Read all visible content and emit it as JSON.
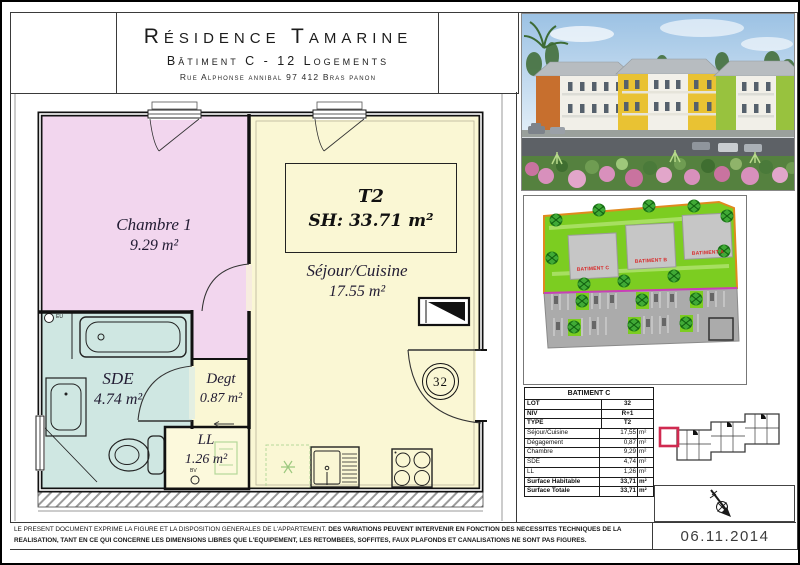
{
  "header": {
    "title": "Résidence Tamarine",
    "subtitle": "Bâtiment C - 12 Logements",
    "address": "Rue Alphonse annibal 97 412 Bras panon"
  },
  "plan": {
    "unit_type": "T2",
    "unit_surface": "SH: 33.71 m²",
    "rooms": [
      {
        "name": "Chambre 1",
        "area": "9.29 m²"
      },
      {
        "name": "Séjour/Cuisine",
        "area": "17.55 m²"
      },
      {
        "name": "SDE",
        "area": "4.74 m²"
      },
      {
        "name": "Degt",
        "area": "0.87 m²"
      },
      {
        "name": "LL",
        "area": "1.26 m²"
      }
    ],
    "lot_number": "32",
    "marks": {
      "eu": "EU",
      "bv": "BV"
    }
  },
  "site_plan": {
    "buildings": [
      "BATIMENT C",
      "BATIMENT B",
      "BATIMENT A"
    ]
  },
  "table": {
    "title": "BATIMENT C",
    "rows": [
      {
        "label": "LOT",
        "value": "32",
        "unit": ""
      },
      {
        "label": "NIV",
        "value": "R+1",
        "unit": ""
      },
      {
        "label": "TYPE",
        "value": "T2",
        "unit": ""
      },
      {
        "label": "Séjour/Cuisine",
        "value": "17,55",
        "unit": "m²"
      },
      {
        "label": "Dégagement",
        "value": "0,87",
        "unit": "m²"
      },
      {
        "label": "Chambre",
        "value": "9,29",
        "unit": "m²"
      },
      {
        "label": "SDE",
        "value": "4,74",
        "unit": "m²"
      },
      {
        "label": "LL",
        "value": "1,26",
        "unit": "m²"
      },
      {
        "label": "Surface Habitable",
        "value": "33,71",
        "unit": "m²"
      },
      {
        "label": "Surface Totale",
        "value": "33,71",
        "unit": "m²"
      }
    ]
  },
  "footer": {
    "disclaimer_line1_normal": "LE PRESENT DOCUMENT EXPRIME LA FIGURE ET LA DISPOSITION GENERALES DE L'APPARTEMENT. ",
    "disclaimer_line1_bold": "DES VARIATIONS PEUVENT INTERVENIR EN FONCTION DES NECESSITES TECHNIQUES DE LA",
    "disclaimer_line2": "REALISATION, TANT EN CE QUI CONCERNE LES DIMENSIONS LIBRES QUE L'EQUIPEMENT, LES RETOMBEES, SOFFITES, FAUX PLAFONDS ET CANALISATIONS NE SONT PAS FIGURES.",
    "date": "06.11.2014"
  },
  "colors": {
    "chambre_pink": "#f2d6ee",
    "sejour_cream": "#faf7d4",
    "sde_teal": "#cfe7e2",
    "site_green": "#7ccd21",
    "highlight_red": "#d02a50"
  }
}
